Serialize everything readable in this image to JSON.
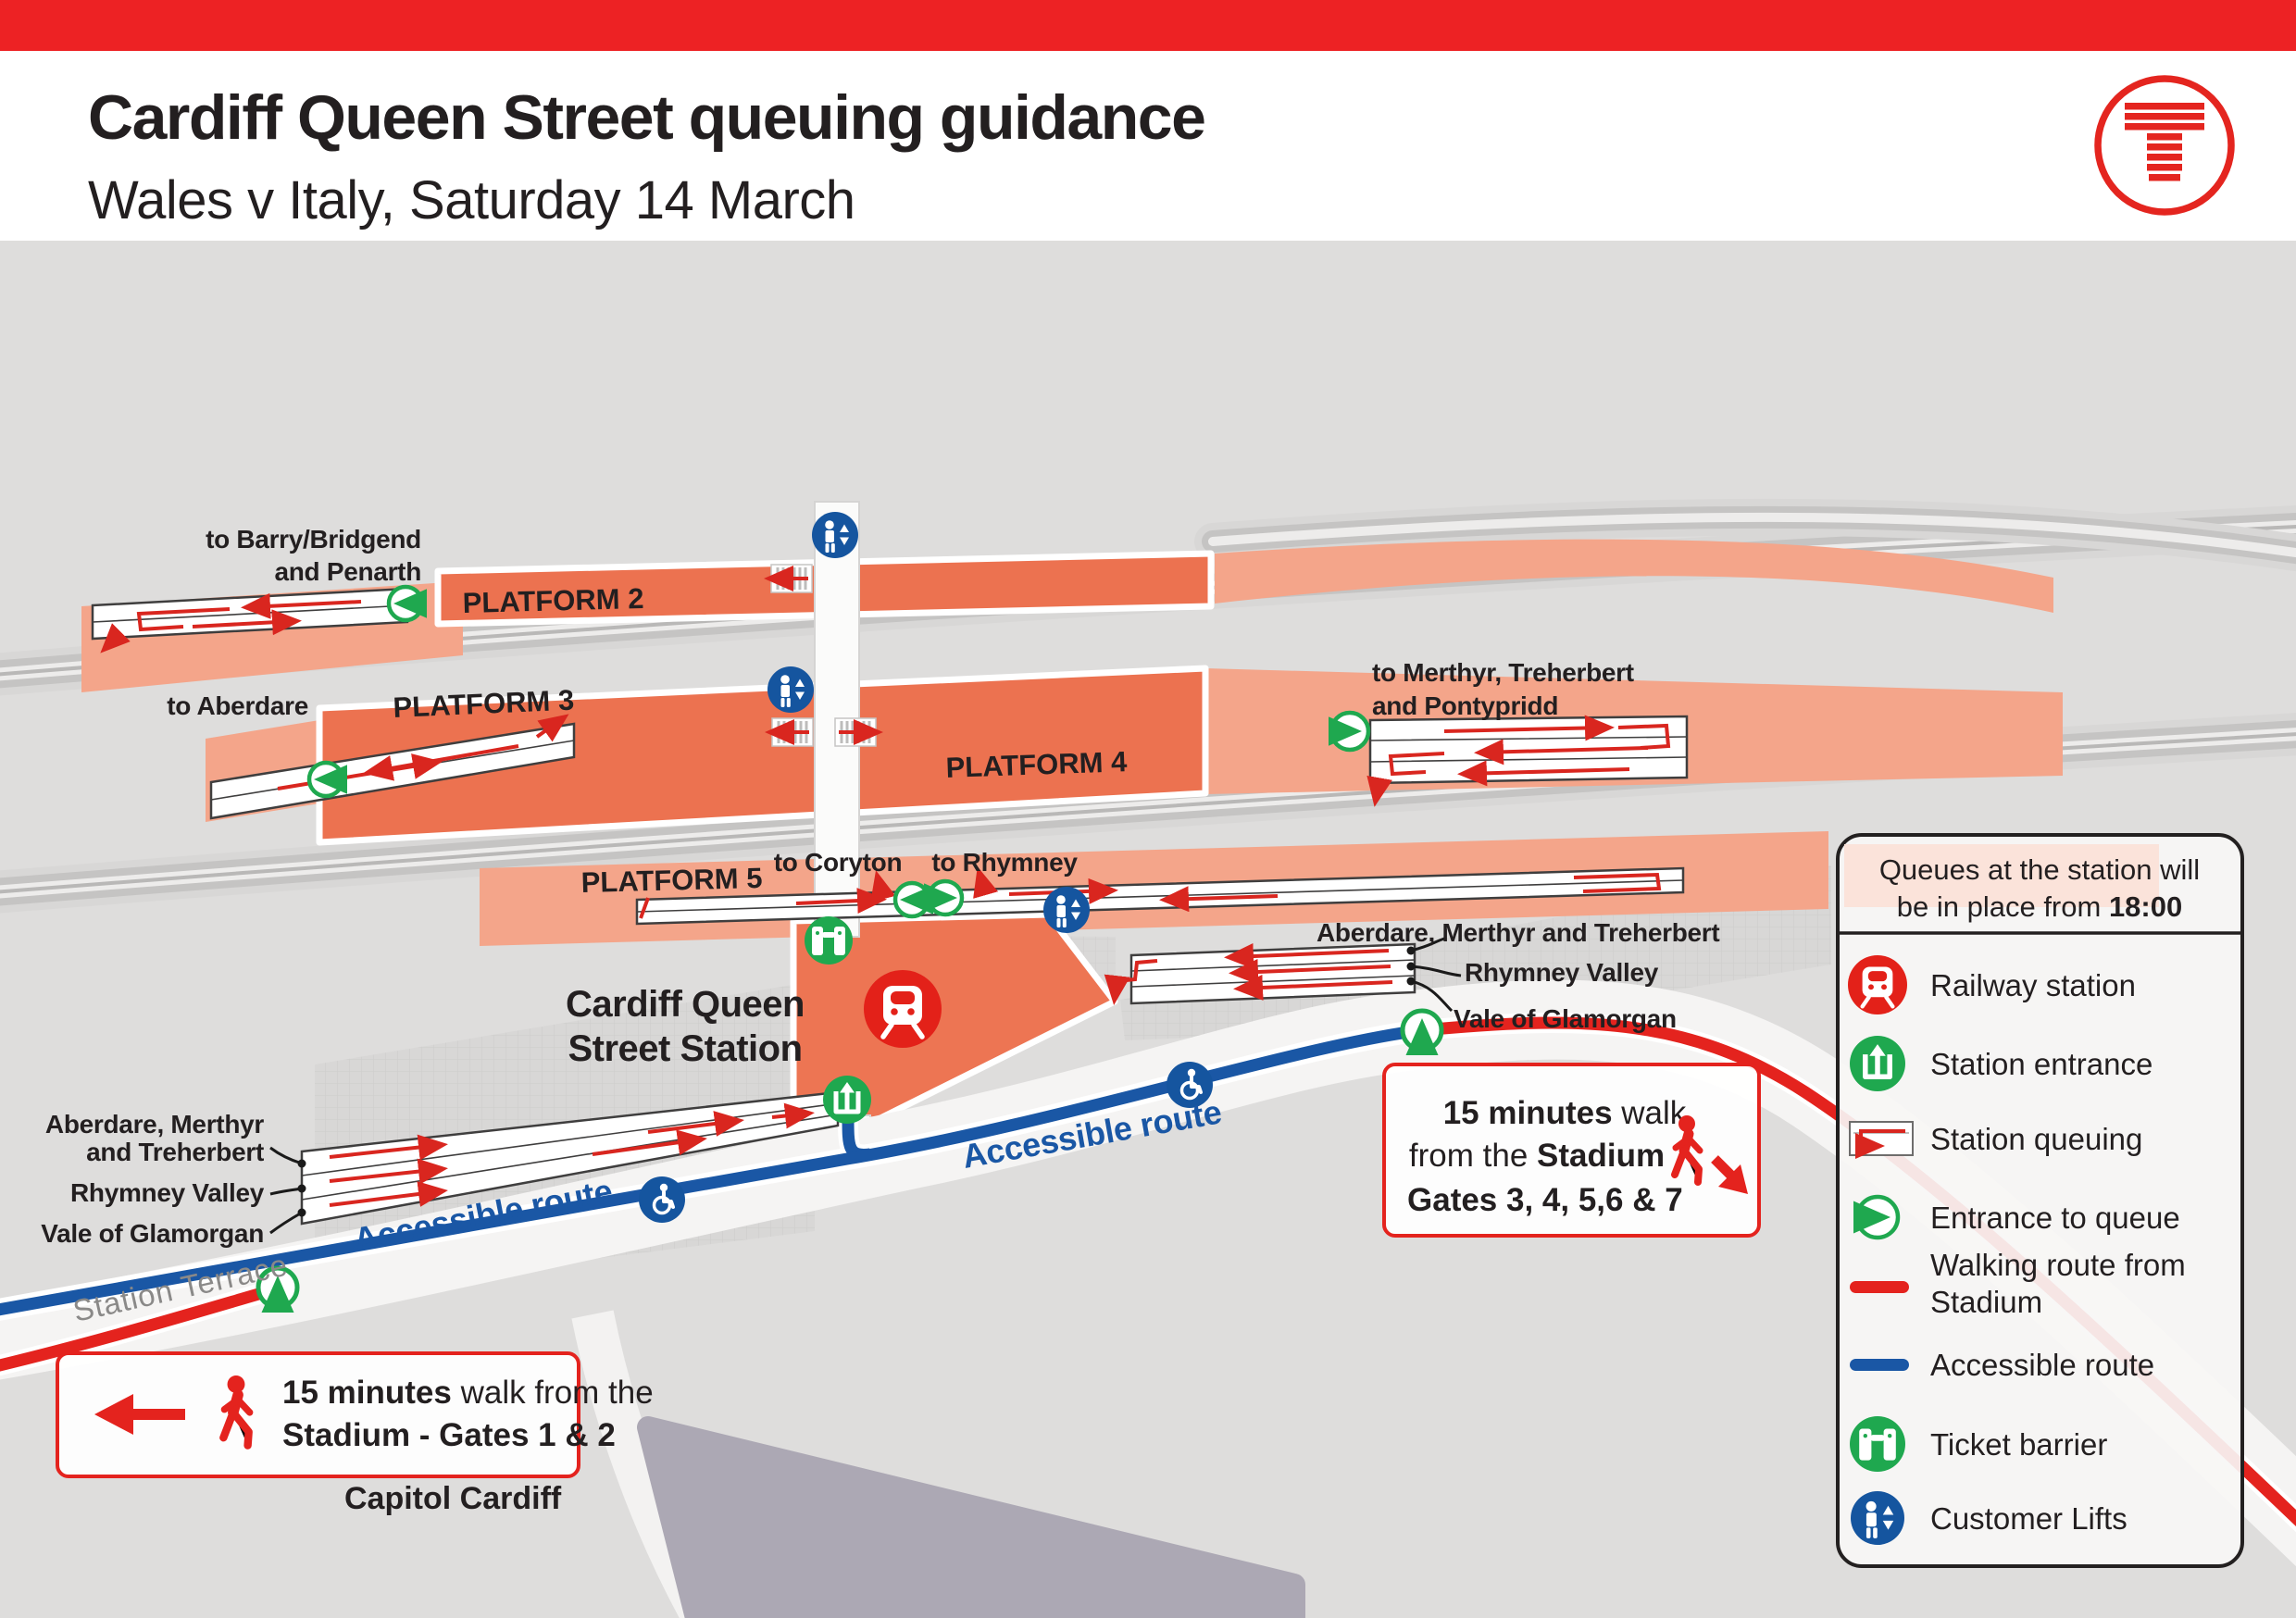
{
  "header": {
    "title": "Cardiff Queen Street queuing guidance",
    "subtitle": "Wales v Italy, Saturday 14 March"
  },
  "platforms": {
    "p2": "PLATFORM 2",
    "p3": "PLATFORM 3",
    "p4": "PLATFORM 4",
    "p5": "PLATFORM 5"
  },
  "destinations": {
    "barry_line1": "to Barry/Bridgend",
    "barry_line2": "and Penarth",
    "aberdare": "to Aberdare",
    "merthyr_line1": "to Merthyr, Treherbert",
    "merthyr_line2": "and Pontypridd",
    "coryton": "to Coryton",
    "rhymney": "to Rhymney"
  },
  "station": {
    "name_line1": "Cardiff Queen",
    "name_line2": "Street Station"
  },
  "queue_lines_right": {
    "line1": "Aberdare, Merthyr and Treherbert",
    "line2": "Rhymney Valley",
    "line3": "Vale of Glamorgan"
  },
  "queue_lines_left": {
    "line1a": "Aberdare, Merthyr",
    "line1b": "and Treherbert",
    "line2": "Rhymney Valley",
    "line3": "Vale of Glamorgan"
  },
  "routes": {
    "accessible_left": "Accessible route",
    "accessible_right": "Accessible route",
    "street": "Station Terrace",
    "capitol": "Capitol Cardiff"
  },
  "walk_box_left": {
    "bold1": "15 minutes",
    "regular1": " walk from the",
    "line2": "Stadium - Gates 1 & 2"
  },
  "walk_box_right": {
    "bold1": "15 minutes",
    "regular1": " walk",
    "regular2": "from the ",
    "bold2": "Stadium",
    "line3": "Gates 3, 4, 5,6 & 7"
  },
  "legend": {
    "header_line1": "Queues at the station will",
    "header_line2_regular": "be in place from ",
    "header_line2_bold": "18:00",
    "items": [
      {
        "label": "Railway station"
      },
      {
        "label": "Station entrance"
      },
      {
        "label": "Station queuing"
      },
      {
        "label": "Entrance to queue"
      },
      {
        "label": "Walking route from",
        "label2": "Stadium"
      },
      {
        "label": "Accessible route"
      },
      {
        "label": "Ticket barrier"
      },
      {
        "label": "Customer Lifts"
      }
    ]
  },
  "colors": {
    "brand_red": "#E4251F",
    "train_red": "#E32119",
    "platform_orange": "#EC7250",
    "salmon": "#F4A58A",
    "green": "#1FA84F",
    "lift_blue": "#15559F",
    "route_blue": "#1A57A5",
    "route_red": "#E4231E",
    "map_bg": "#DEDDDC"
  }
}
